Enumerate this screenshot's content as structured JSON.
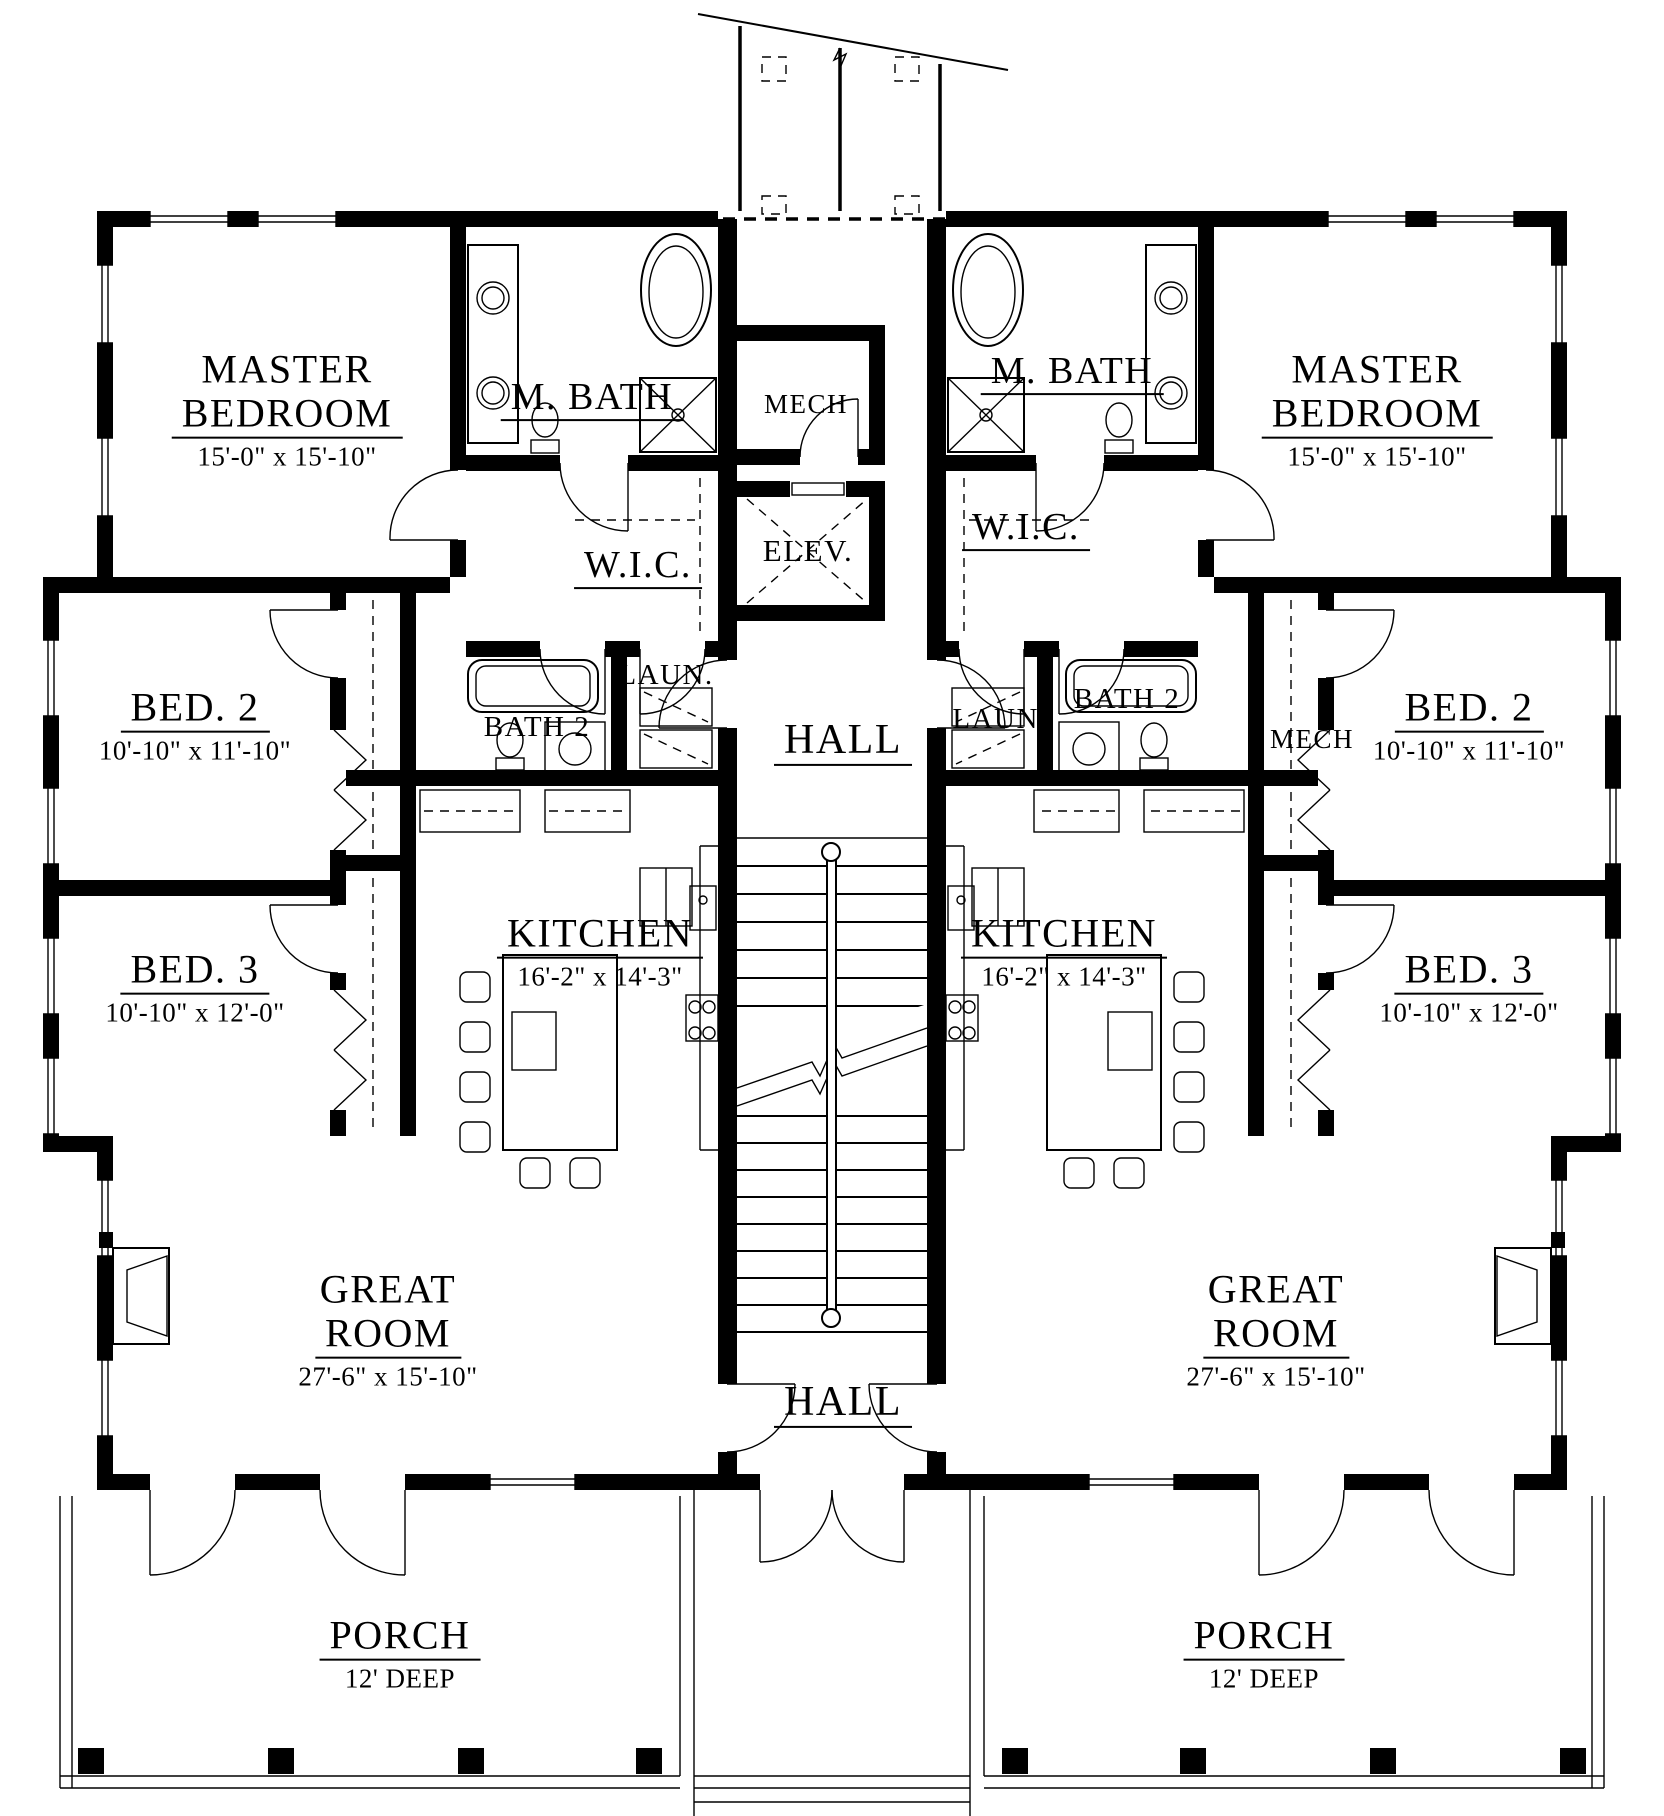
{
  "core": {
    "mech_label": "MECH",
    "elev_label": "ELEV.",
    "upper_hall_label": "HALL",
    "lower_hall_label": "HALL"
  },
  "left_unit": {
    "master_line1": "MASTER",
    "master_line2": "BEDROOM",
    "master_dims": "15'-0\" x 15'-10\"",
    "mbath_label": "M. BATH",
    "wic_label": "W.I.C.",
    "laundry_label": "LAUN.",
    "bath2_label": "BATH 2",
    "bed2_label": "BED. 2",
    "bed2_dims": "10'-10\" x 11'-10\"",
    "bed3_label": "BED. 3",
    "bed3_dims": "10'-10\" x 12'-0\"",
    "kitchen_label": "KITCHEN",
    "kitchen_dims": "16'-2\" x 14'-3\"",
    "great_line1": "GREAT",
    "great_line2": "ROOM",
    "great_dims": "27'-6\" x 15'-10\"",
    "porch_label": "PORCH",
    "porch_dims": "12' DEEP"
  },
  "right_unit": {
    "master_line1": "MASTER",
    "master_line2": "BEDROOM",
    "master_dims": "15'-0\" x 15'-10\"",
    "mbath_label": "M. BATH",
    "wic_label": "W.I.C.",
    "laundry_label": "LAUN.",
    "bath2_label": "BATH 2",
    "mech_label": "MECH",
    "bed2_label": "BED. 2",
    "bed2_dims": "10'-10\" x 11'-10\"",
    "bed3_label": "BED. 3",
    "bed3_dims": "10'-10\" x 12'-0\"",
    "kitchen_label": "KITCHEN",
    "kitchen_dims": "16'-2\" x 14'-3\"",
    "great_line1": "GREAT",
    "great_line2": "ROOM",
    "great_dims": "27'-6\" x 15'-10\"",
    "porch_label": "PORCH",
    "porch_dims": "12' DEEP"
  }
}
